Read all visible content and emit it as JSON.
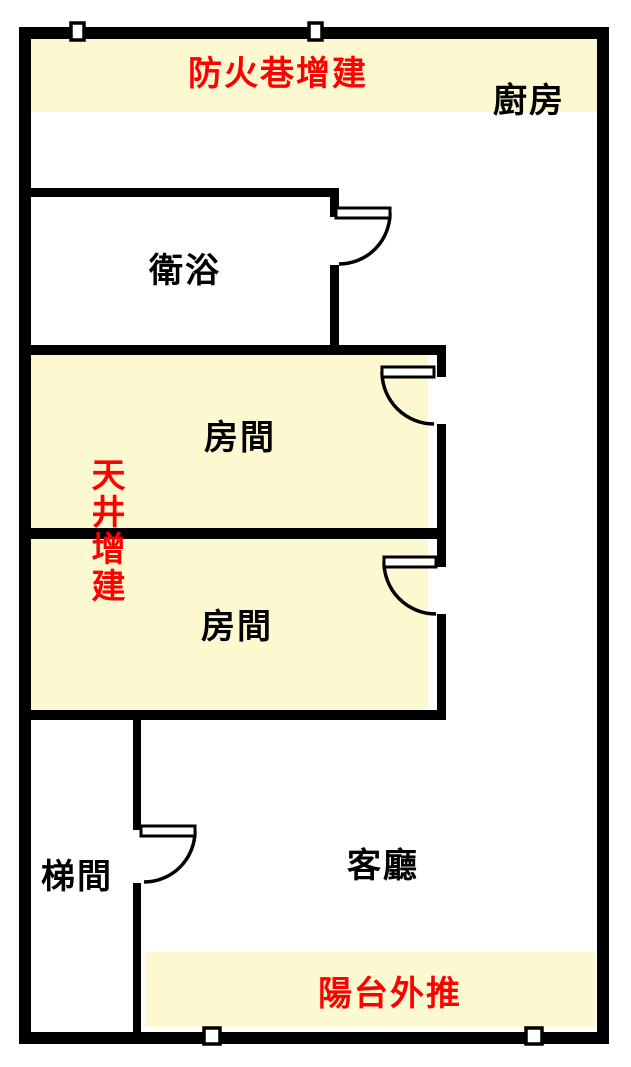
{
  "document": {
    "type": "apartment-floor-plan"
  },
  "colors": {
    "wall": "#000000",
    "highlight_yellow": "#FCF9D0",
    "annotation_red": "#FF0000",
    "room_label_black": "#000000",
    "background": "#FFFFFF"
  },
  "rooms": [
    {
      "id": "kitchen",
      "label": "廚房"
    },
    {
      "id": "bathroom",
      "label": "衛浴"
    },
    {
      "id": "room-1",
      "label": "房間"
    },
    {
      "id": "room-2",
      "label": "房間"
    },
    {
      "id": "stairwell",
      "label": "梯間"
    },
    {
      "id": "living-room",
      "label": "客廳"
    }
  ],
  "annotations": [
    {
      "id": "fire-lane-addition",
      "label": "防火巷增建",
      "orientation": "horizontal"
    },
    {
      "id": "skylight-addition",
      "label": "天井增建",
      "orientation": "vertical"
    },
    {
      "id": "balcony-pushout",
      "label": "陽台外推",
      "orientation": "horizontal"
    }
  ],
  "features": {
    "door_count": "4",
    "window_count": "4",
    "highlight_zone_count": "4"
  }
}
